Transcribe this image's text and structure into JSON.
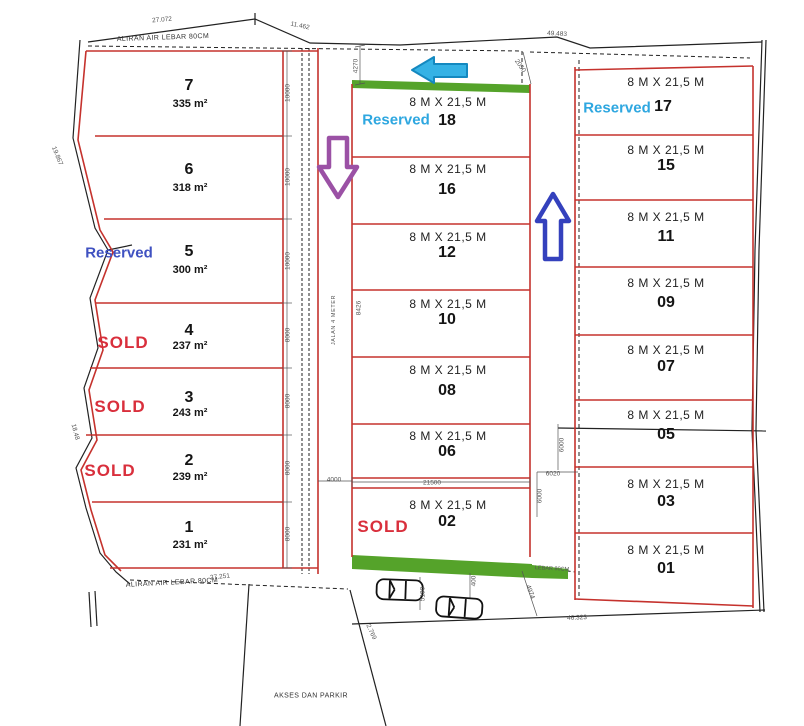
{
  "site": {
    "channel_top": "ALIRAN AIR  LEBAR 80CM",
    "channel_bottom": "ALIRAN AIR LEBAR 80CM",
    "channel_right": "LEBAR 80CM",
    "road": "JALAN 4 METER",
    "access": "AKSES DAN PARKIR"
  },
  "left_plots": [
    {
      "number": "7",
      "area": "335 m²"
    },
    {
      "number": "6",
      "area": "318 m²"
    },
    {
      "number": "5",
      "area": "300 m²",
      "status": "Reserved"
    },
    {
      "number": "4",
      "area": "237 m²",
      "status": "SOLD"
    },
    {
      "number": "3",
      "area": "243 m²",
      "status": "SOLD"
    },
    {
      "number": "2",
      "area": "239 m²",
      "status": "SOLD"
    },
    {
      "number": "1",
      "area": "231 m²"
    }
  ],
  "middle_plots": [
    {
      "number": "18",
      "size": "8 M X 21,5 M",
      "status": "Reserved"
    },
    {
      "number": "16",
      "size": "8 M X 21,5 M"
    },
    {
      "number": "12",
      "size": "8 M X 21,5 M"
    },
    {
      "number": "10",
      "size": "8 M X 21,5 M"
    },
    {
      "number": "08",
      "size": "8 M X 21,5 M"
    },
    {
      "number": "06",
      "size": "8 M X 21,5 M"
    },
    {
      "number": "02",
      "size": "8 M X 21,5 M",
      "status": "SOLD"
    }
  ],
  "right_plots": [
    {
      "number": "17",
      "size": "8 M X 21,5 M",
      "status": "Reserved"
    },
    {
      "number": "15",
      "size": "8 M X 21,5 M"
    },
    {
      "number": "11",
      "size": "8 M X 21,5 M"
    },
    {
      "number": "09",
      "size": "8 M X 21,5 M"
    },
    {
      "number": "07",
      "size": "8 M X 21,5 M"
    },
    {
      "number": "05",
      "size": "8 M X 21,5 M"
    },
    {
      "number": "03",
      "size": "8 M X 21,5 M"
    },
    {
      "number": "01",
      "size": "8 M X 21,5 M"
    }
  ],
  "dims": {
    "top_left": "27.072",
    "top_mid": "11.462",
    "top_right": "49.483",
    "gap_top": "4270",
    "gap_diag": "2050",
    "lot7": "10000",
    "lot6": "10000",
    "lot5": "10000",
    "lot4": "8000",
    "lot3": "8000",
    "lot2": "8000",
    "lot1": "8000",
    "road_width": "4000",
    "block_width": "21500",
    "road_length": "8426",
    "alley_top": "6000",
    "alley_width": "6020",
    "alley_bottom": "6000",
    "park_depth": "5190",
    "park_a": "400",
    "park_b": "4974",
    "park_c": "2.769",
    "bottom_right": "46.323",
    "bottom_left": "27.251",
    "edge_top": "19.867",
    "edge_bottom": "18.48"
  },
  "colors": {
    "plot_border": "#c5322d",
    "green_strip": "#55a32a",
    "sold": "#d92f3c",
    "reserved_cyan": "#2ea7e0",
    "reserved_blue": "#3f51c1",
    "arrow_cyan": "#35b2e5",
    "arrow_purple": "#9b51a5",
    "arrow_blue": "#3441bd"
  }
}
